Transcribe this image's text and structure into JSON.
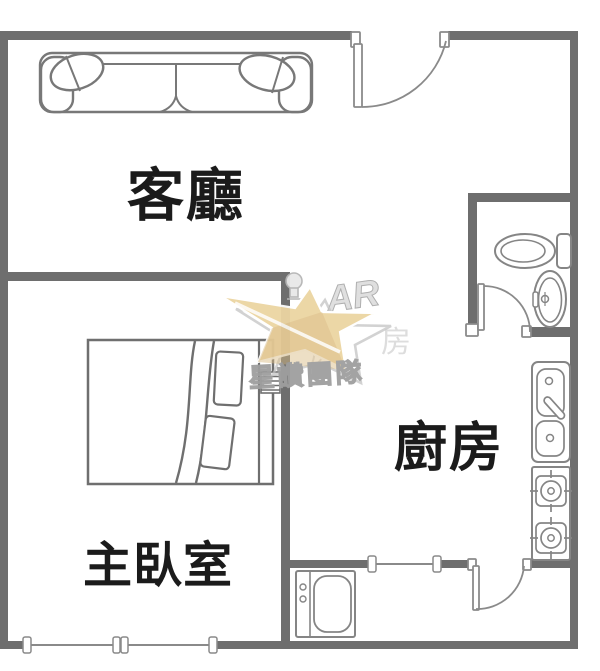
{
  "plan_title": "apartment-floorplan",
  "rooms": {
    "living_room": {
      "label": "客廳"
    },
    "master_bedroom": {
      "label": "主臥室"
    },
    "kitchen": {
      "label": "廚房"
    }
  },
  "fixtures": [
    "sofa",
    "throw-pillows",
    "bed",
    "bed-pillows",
    "blanket-fold",
    "ac-unit",
    "toilet",
    "bathroom-basin",
    "kitchen-sink",
    "gas-stove-two-burners",
    "washing-machine",
    "entrance-door",
    "bathroom-door",
    "utility-door",
    "bedroom-window",
    "utility-window"
  ],
  "watermark": {
    "team_name": "星讚團隊",
    "logo_letters": "AR",
    "faint_chars": [
      "房",
      "房"
    ],
    "star_color": "#ecd5a2",
    "star_shade_color": "#d9bc84",
    "outline_color": "#bdbdbd"
  },
  "colors": {
    "wall": "#6e6e6e",
    "furniture_line": "#808080",
    "label_text": "#1b1b1b",
    "background": "#ffffff"
  }
}
